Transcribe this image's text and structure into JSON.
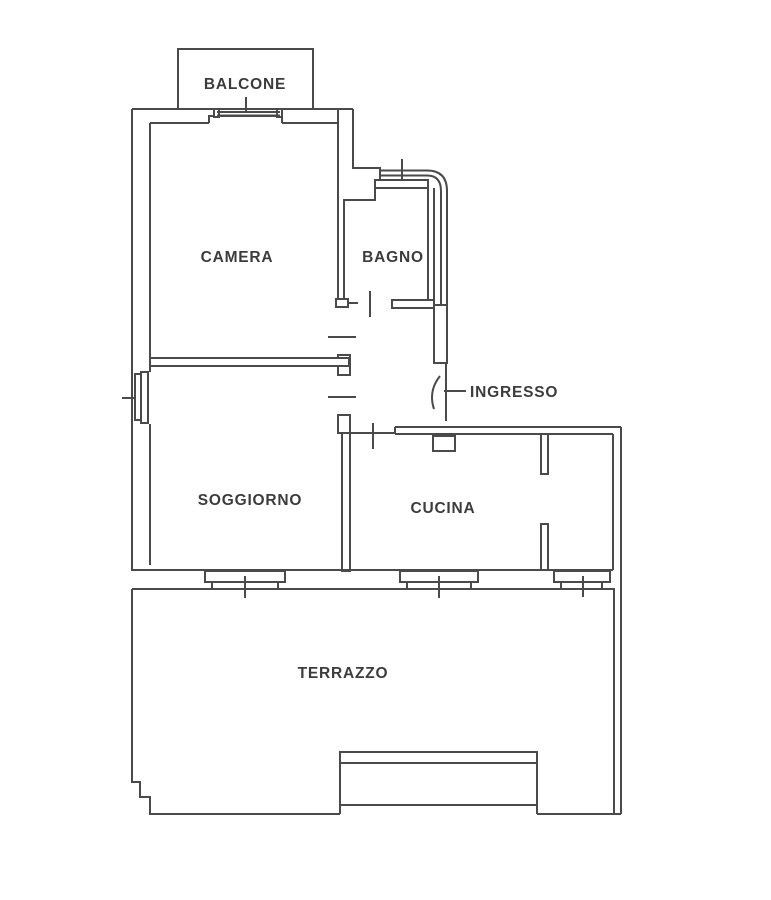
{
  "plan": {
    "background": "#ffffff",
    "line_color": "#4a4a4a",
    "label_color": "#3c3c3c"
  },
  "rooms": {
    "balcone": {
      "label": "BALCONE"
    },
    "camera": {
      "label": "CAMERA"
    },
    "bagno": {
      "label": "BAGNO"
    },
    "ingresso": {
      "label": "INGRESSO"
    },
    "soggiorno": {
      "label": "SOGGIORNO"
    },
    "cucina": {
      "label": "CUCINA"
    },
    "terrazzo": {
      "label": "TERRAZZO"
    }
  }
}
